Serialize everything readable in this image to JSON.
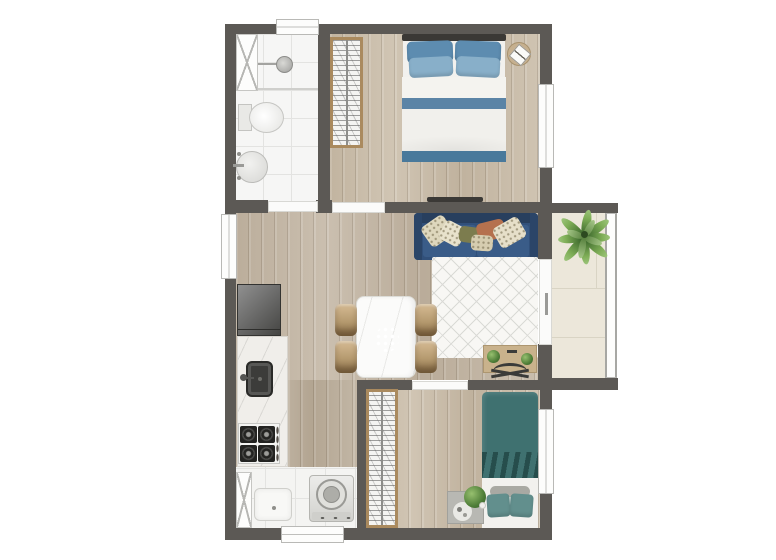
{
  "plan": {
    "type": "apartment-floor-plan",
    "view": "top-down 3D render",
    "rooms": [
      {
        "name": "Bathroom",
        "features": [
          "shower box",
          "shower head",
          "glass partition",
          "toilet",
          "round basin",
          "window"
        ]
      },
      {
        "name": "Bedroom 1",
        "features": [
          "double bed",
          "blue pillows",
          "white duvet with blue bands",
          "wardrobe",
          "round nightstand",
          "wall tv",
          "window"
        ]
      },
      {
        "name": "Living / Dining",
        "features": [
          "navy three-seat sofa",
          "patterned throw pillows",
          "diamond lattice rug",
          "marble dining table",
          "plant centerpiece",
          "four wood chairs",
          "desk with plants",
          "desk chair"
        ]
      },
      {
        "name": "Kitchen",
        "features": [
          "refrigerator",
          "marble counter",
          "dark square sink",
          "four-burner stove"
        ]
      },
      {
        "name": "Laundry",
        "features": [
          "tall cabinet",
          "laundry tub",
          "top-load washing machine",
          "service door"
        ]
      },
      {
        "name": "Bedroom 2",
        "features": [
          "single bed",
          "teal duvet",
          "teal pillows",
          "wardrobe",
          "gray nightstand with tray and plant",
          "window"
        ]
      },
      {
        "name": "Balcony",
        "features": [
          "palm plant",
          "large cream tiles",
          "railing",
          "sliding glass door"
        ]
      }
    ]
  },
  "colors": {
    "wall": "#5c5955",
    "wood": "#c3b6a4",
    "wood2": "#cabda9",
    "wood3": "#bbae9b",
    "tile": "#f6f6f5",
    "tileLine": "#e3e3e1",
    "balcony": "#ece7da",
    "balconyLine": "#d9d4c4",
    "sofa": "#31507a",
    "sofaDark": "#283f5e",
    "sofaSeat": "#3a5c88",
    "rug": "#f8f7f4",
    "rugLine": "#dadad6",
    "pillowBlue": "#5d8cb0",
    "pillowBlueLight": "#88afc9",
    "bandBlue": "#5b84a6",
    "bandBlue2": "#49799b",
    "teal": "#3f7170",
    "tealDark": "#2f5c59",
    "tealLight": "#628f8d",
    "bedWhite": "#f2f1ee",
    "woodFurn": "#c9b28c",
    "closetFrame": "#aa8a5e",
    "marble": "#fbfbfa",
    "grayFurn": "#b8b8b3",
    "charcoal": "#3a3835"
  }
}
